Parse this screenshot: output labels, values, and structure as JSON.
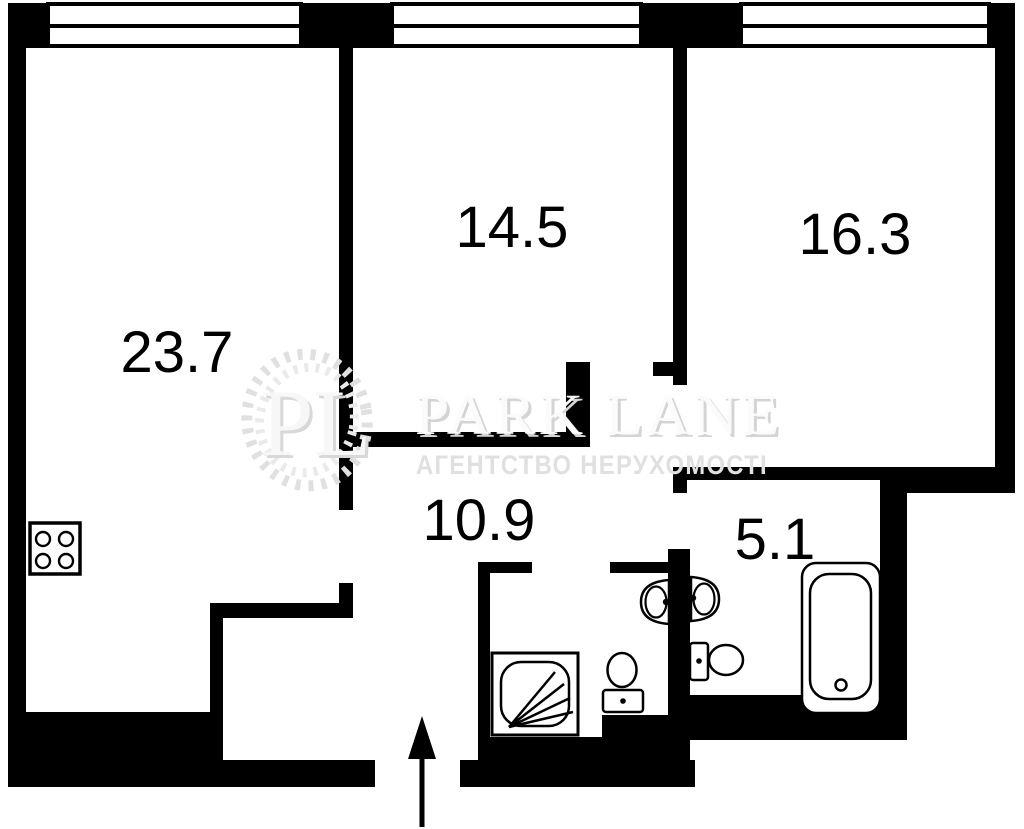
{
  "plan": {
    "rooms": [
      {
        "area": "23.7"
      },
      {
        "area": "14.5"
      },
      {
        "area": "16.3"
      },
      {
        "area": "10.9"
      },
      {
        "area": "5.1"
      }
    ],
    "windows": 3,
    "entrance_arrow": "up",
    "fixtures": [
      "stove-icon",
      "shower-icon",
      "sink-icon",
      "sink-icon",
      "toilet-icon",
      "toilet-icon",
      "bathtub-icon"
    ]
  },
  "watermark": {
    "monogram": "PL",
    "brand": "PARK LANE",
    "tagline": "АГЕНТСТВО НЕРУХОМОСТІ"
  },
  "colors": {
    "walls": "#000000",
    "background": "#ffffff",
    "watermark_gray": "#e3e3e3"
  }
}
